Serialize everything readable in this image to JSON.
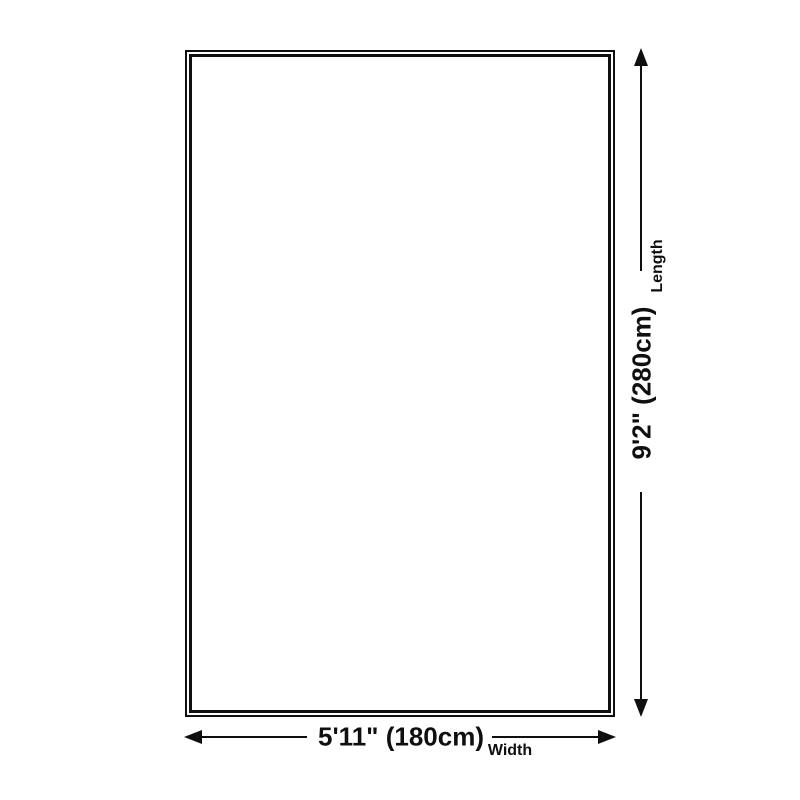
{
  "diagram": {
    "colors": {
      "background": "#ffffff",
      "line": "#0f0f0f"
    },
    "length": {
      "value": "9'2\" (280cm)",
      "label": "Length"
    },
    "width": {
      "value": "5'11\" (180cm)",
      "label": "Width"
    }
  }
}
